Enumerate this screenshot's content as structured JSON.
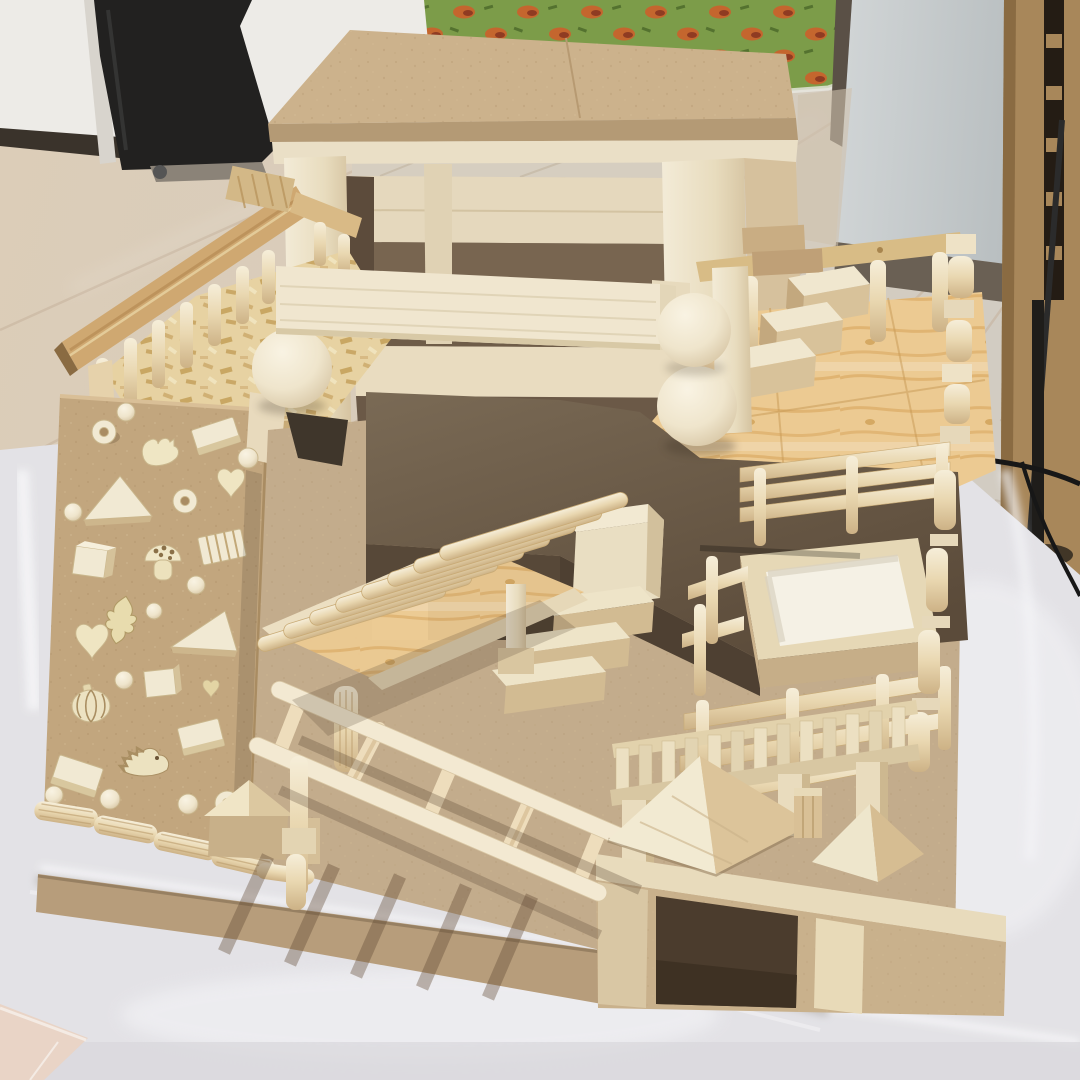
{
  "meta": {
    "type": "photograph",
    "description": "Handmade wooden toy playground model built from craft wood blocks and dowels, standing on a translucent white storage bin in a room with light wood flooring, a white wall, a gray pillar, a patterned play mat and wooden furniture."
  },
  "palette": {
    "wall_white": "#EDEBE7",
    "baseboard_dark": "#3A332B",
    "floor_wood": "#DCCDB8",
    "mat_green": "#7C9C49",
    "mat_spot_orange": "#C4662E",
    "mat_spot_dark": "#8F3B22",
    "pillar_gray": "#C6CBCC",
    "furniture_brown": "#A8875A",
    "cloth_black": "#222120",
    "bin_translucent": "#E3E2E6",
    "tile_pink": "#E9D4C6",
    "mdf_tan": "#CCB28C",
    "mdf_dark_brown": "#6B5A47",
    "wood_pale": "#F0E6CF",
    "pine_deck": "#ECCA92",
    "osb_deck": "#E7D2A2",
    "dowel_wood": "#ECD9B2",
    "ball_cream": "#F2EAD8",
    "cable_black": "#171717"
  },
  "scene": {
    "background": [
      "white-wall",
      "dark-baseboard",
      "wood-floor",
      "play-mat",
      "gray-pillar",
      "wooden-furniture",
      "black-cloth",
      "power-cable",
      "plastic-storage-bin",
      "pink-tile-floor"
    ],
    "playset": {
      "levels": [
        "top tower with flat MDF roof",
        "left balcony with spindle railing",
        "right pine deck with railing and block stairs",
        "center dark-brown MDF platform",
        "ground level with dowel bridge and monkey bars"
      ],
      "parts": [
        "wooden-tower",
        "balance-beam",
        "left-balcony",
        "climbing-wall",
        "fluted-dowel-fence",
        "dowel-bridge",
        "monkey-bars",
        "right-deck",
        "block-stairs",
        "stacked-wooden-balls",
        "sandbox",
        "dowel-fences",
        "slat-fence",
        "hip-roof-house",
        "small-hip-roof",
        "house-box-with-doorway",
        "small-gable-block"
      ],
      "climbing_wall_shapes": [
        "ring",
        "ball",
        "squirrel",
        "block",
        "heart",
        "triangle",
        "mushroom",
        "striped-block",
        "leaf",
        "pumpkin",
        "hedgehog",
        "cube",
        "small-heart"
      ],
      "counts": {
        "wooden_balls": 3,
        "left_balcony_balusters": 7,
        "right_deck_balusters": 4,
        "bridge_rungs": 8,
        "monkey_bar_rungs": 5,
        "fence_slats": 13,
        "climbing_wall_shapes": 28
      }
    }
  }
}
